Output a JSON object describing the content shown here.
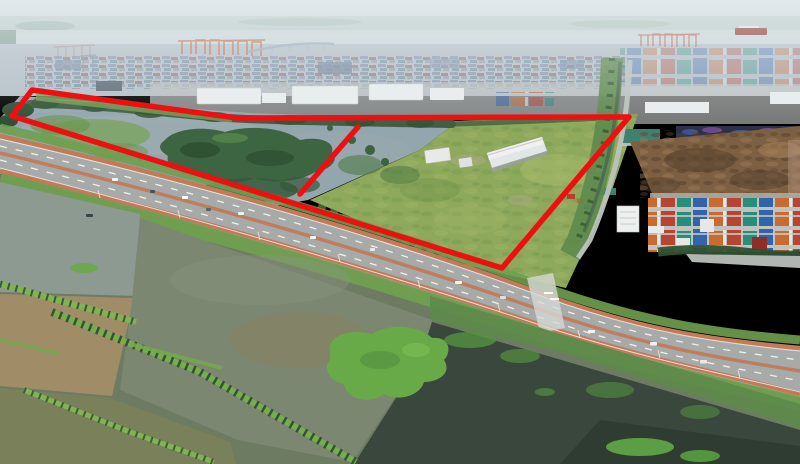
{
  "scene": {
    "type": "aerial-drone-photo-with-site-annotation",
    "annotation": {
      "color": "#ee1010",
      "stroke_width": "5.5",
      "boundary_points": "32,90 237,118 629,117 502,268 12,116",
      "divider_points": "358,127 300,194"
    },
    "palette": {
      "sky_top": "#d9e1e5",
      "sky_bottom": "#c5cfd4",
      "shore_haze": "#a9bfb2",
      "river": "#cdd7da",
      "ship_hull": "#8f3a33",
      "port_base": "#b5bfc7",
      "crane_orange": "#c2663e",
      "crane_red": "#b55a45",
      "hazy_blue": "#8796ad",
      "hazy_red": "#a2756e",
      "hazy_teal": "#7d95a0",
      "hazy_slate": "#96a1b0",
      "warehouse_white": "#e9edee",
      "ground_grey": "#bcc0c1",
      "tree_dark": "#3a573c",
      "water_grey": "#93a5ad",
      "water_light": "#a9b7bb",
      "marsh_green": "#6f9950",
      "mangrove_dark": "#39613c",
      "mangrove_deep": "#2a4a2c",
      "field_green": "#8ea95c",
      "field_light": "#a7b96a",
      "field_dark": "#6f9448",
      "canal_green": "#5d8a4d",
      "canal_water": "#4a6850",
      "path_grey": "#bcc2bc",
      "teal_roof": "#3f8070",
      "tarp_blue": "#4059a8",
      "tarp_purple": "#7a4f9e",
      "timber_brown": "#7d5f42",
      "timber_dark": "#54402b",
      "timber_light": "#9a7a55",
      "container_red": "#b5402c",
      "container_orange": "#c8662c",
      "container_teal": "#1f8b78",
      "container_blue": "#2c5ea8",
      "container_white": "#e6e8e7",
      "container_maroon": "#8e2e26",
      "yard_grey": "#c0c2be",
      "office_white": "#eef0ef",
      "road_grey": "#a6abaa",
      "road_tan": "#c27a59",
      "lane_white": "#f2f4f2",
      "verge_green": "#6fa050",
      "scrub_green": "#5d8a4a",
      "pond_grey": "#8d9a92",
      "pond_brown": "#a08d68",
      "pond_olive": "#79805a",
      "pond_mid": "#7b8770",
      "pond_tinge": "#8a7f5e",
      "water_dark": "#39473c",
      "water_darker": "#2e3b31",
      "veg_bright": "#69aa48",
      "dike_green": "#7fb356",
      "palm_dark": "#2e4a2a",
      "boat_dark": "#3c4246",
      "vehicle_white": "#f2f3f2",
      "vehicle_dark": "#4a525a",
      "fg_base": "#6e7b63",
      "haze": "#e6eef2"
    }
  }
}
